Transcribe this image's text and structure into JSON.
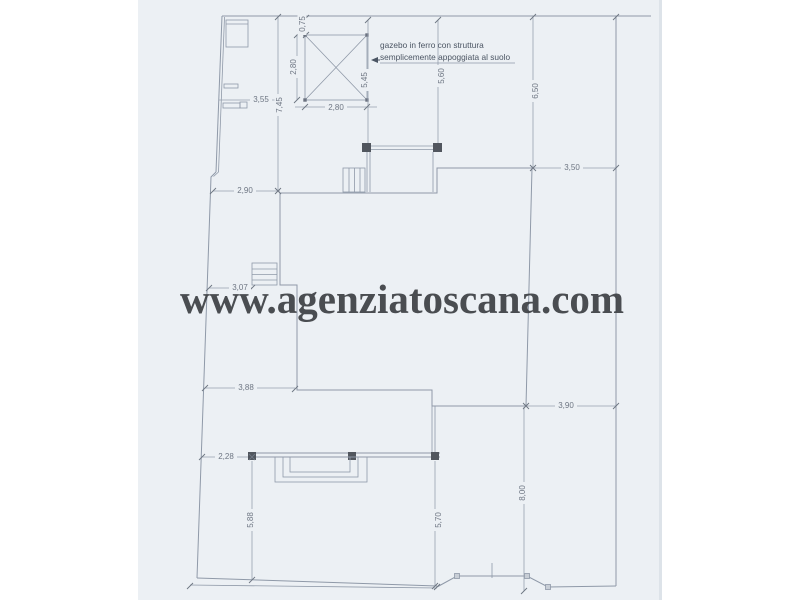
{
  "watermark": {
    "text": "www.agenziatoscana.com"
  },
  "annotation": {
    "line1": "gazebo in ferro con struttura",
    "line2": "semplicemente appoggiata al suolo"
  },
  "dimensions": {
    "gazebo_top_offset": "0,75",
    "gazebo_height": "2,80",
    "gazebo_width": "2,80",
    "gazebo_to_building": "5,45",
    "boundary_to_terrace": "5,60",
    "boundary_to_building_right": "6,50",
    "building_to_right_boundary_top": "3,50",
    "left_boundary_upper": "7,45",
    "left_boundary_width": "3,55",
    "setback_upper_left": "2,90",
    "setback_mid_left": "3,07",
    "setback_lower_left": "3,88",
    "setback_bottom_left": "2,28",
    "garden_depth_left": "5,88",
    "garden_depth_right": "5,70",
    "garden_depth_center": "8,00",
    "building_to_right_boundary_bottom": "3,90"
  },
  "colors": {
    "page": "#ecf0f4",
    "line": "#8f99a8",
    "dimline": "#99a2b0",
    "dimtext": "#6e7683",
    "annotation": "#4b5563",
    "watermark": "#3e4145",
    "dark": "#51565e",
    "hatch": "#b8c0ca"
  }
}
